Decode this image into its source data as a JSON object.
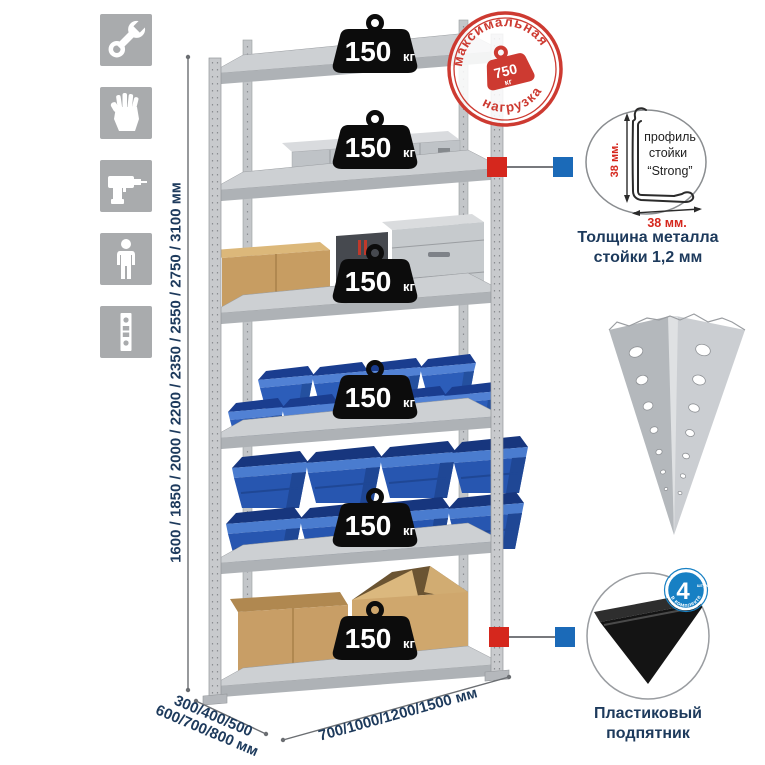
{
  "dimensions": {
    "height_label": "1600 / 1850 / 2000 / 2200 / 2350 / 2550 / 2750 / 3100 мм",
    "depth_label_line1": "300/400/500",
    "depth_label_line2": "600/700/800 мм",
    "width_label": "700/1000/1200/1500 мм"
  },
  "rack": {
    "shelves": [
      {
        "load_value": "150",
        "load_unit": "кг"
      },
      {
        "load_value": "150",
        "load_unit": "кг"
      },
      {
        "load_value": "150",
        "load_unit": "кг"
      },
      {
        "load_value": "150",
        "load_unit": "кг"
      },
      {
        "load_value": "150",
        "load_unit": "кг"
      },
      {
        "load_value": "150",
        "load_unit": "кг"
      }
    ]
  },
  "max_load_stamp": {
    "arc_top": "максимальная",
    "arc_bottom": "нагрузка",
    "value": "750",
    "unit": "кг"
  },
  "profile_detail": {
    "label_line1": "профиль",
    "label_line2": "стойки",
    "label_line3": "“Strong”",
    "dim_vertical": "38 мм.",
    "dim_horizontal": "38 мм.",
    "caption_line1": "Толщина металла",
    "caption_line2": "стойки 1,2 мм"
  },
  "foot_detail": {
    "badge_number": "4",
    "badge_word": "штуки",
    "badge_arc": "в комплекте",
    "caption_line1": "Пластиковый",
    "caption_line2": "подпятник"
  },
  "colors": {
    "accent_red": "#d5271d",
    "accent_blue": "#1b6ab8",
    "stamp_red": "#cd3a31",
    "navy_text": "#1d3a5c",
    "bin_blue": "#2c5db9"
  }
}
